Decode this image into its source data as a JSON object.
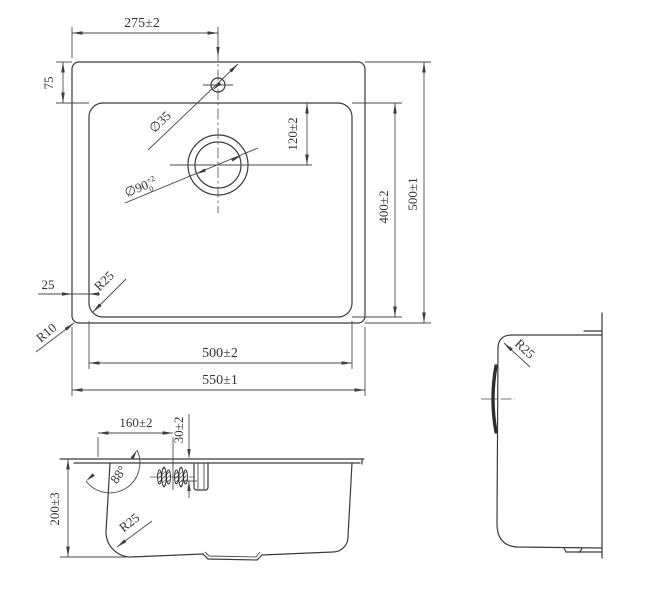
{
  "plan": {
    "faucet_offset": "275±2",
    "deck_top": "75",
    "faucet_hole_dia": "∅35",
    "drain_from_top": "120±2",
    "bowl_depth": "400±2",
    "overall_depth": "500±1",
    "deck_side": "25",
    "bowl_corner_radius": "R25",
    "outer_corner_radius": "R10",
    "bowl_width": "500±2",
    "overall_width": "550±1",
    "drain_dia": "∅90",
    "drain_tol_upper": "+2",
    "drain_tol_lower": "0"
  },
  "front": {
    "overflow_offset": "160±2",
    "overflow_drop": "30±2",
    "bowl_height": "200±3",
    "wall_angle": "88°",
    "bottom_corner_radius": "R25"
  },
  "side": {
    "corner_radius": "R25"
  }
}
